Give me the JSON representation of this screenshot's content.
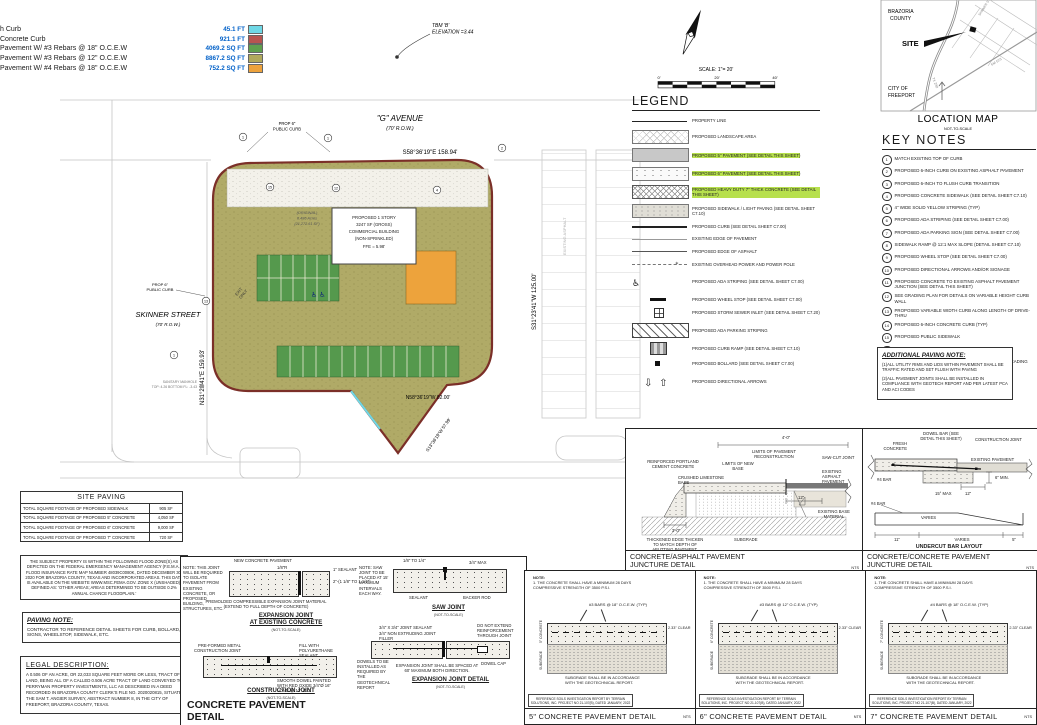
{
  "quantities": {
    "rows": [
      {
        "label": "h Curb",
        "value": "45.1 FT",
        "color": "#6fd8e6"
      },
      {
        "label": "Concrete Curb",
        "value": "921.1 FT",
        "color": "#b85450"
      },
      {
        "label": "Pavement W/ #3 Rebars @ 18\" O.C.E.W",
        "value": "4069.2 SQ FT",
        "color": "#5fa04e"
      },
      {
        "label": "Pavement W/ #3 Rebars @ 12\" O.C.E.W",
        "value": "8867.2 SQ FT",
        "color": "#b0a95c"
      },
      {
        "label": "Pavement W/ #4 Rebars @ 18\" O.C.E.W",
        "value": "752.2 SQ FT",
        "color": "#eda23c"
      }
    ]
  },
  "north_scale": {
    "label": "SCALE: 1\"= 20'",
    "t0": "0'",
    "t1": "20'",
    "t2": "40'"
  },
  "plan": {
    "tbm_1": "TBM 'B'",
    "tbm_2": "ELEVATION =3.44",
    "g_avenue": "\"G\" AVENUE",
    "g_avenue_row": "(70' R.O.W.)",
    "skinner": "SKINNER STREET",
    "skinner_row": "(70' R.O.W.)",
    "prop_curb_1": "PROP 6\"",
    "prop_curb_2": "PUBLIC CURB",
    "bearing_top": "S58°36'19\"E   158.94'",
    "bearing_left": "N31°23'41\"E   159.93'",
    "bearing_right": "S31°23'41\"W   125.00'",
    "bearing_bottom": "N58°36'19\"W 82.00'",
    "bearing_diag": "S13°36'19\"W 57.99'",
    "building": [
      "PROPOSED 1 STORY",
      "3247 SF (GROSS)",
      "COMMERCIAL BUILDING",
      "(NON-SPRINKLED)",
      "FFE = 5.98'"
    ],
    "parcel": [
      "(ORIGINAL)",
      "0.486 Acres",
      "(21,272.61 SF)"
    ],
    "exit_1": "EXIT",
    "exit_2": "ONLY",
    "ada_symbols": "♿ ♿",
    "sanitary_1": "SANITARY MANHOLE",
    "sanitary_2": "TOP: 4.26  BOTTOM FL: -3.43",
    "existing_asphalt": "EXISTING ASPHALT",
    "callouts": [
      "1",
      "1",
      "15",
      "12",
      "4",
      "13",
      "1",
      "2"
    ]
  },
  "legend": {
    "title": "LEGEND",
    "items": [
      {
        "swatch": "sw-line",
        "label": "PROPERTY LINE"
      },
      {
        "swatch": "sw-landscape",
        "label": "PROPOSED LANDSCAPE AREA"
      },
      {
        "swatch": "sw-5in",
        "label": "PROPOSED 5\" PAVEMENT (SEE DETAIL THIS SHEET)",
        "hl": "hl"
      },
      {
        "swatch": "sw-6in",
        "label": "PROPOSED 6\" PAVEMENT (SEE DETAIL THIS SHEET)",
        "hl": "hl"
      },
      {
        "swatch": "sw-7in",
        "label": "PROPOSED HEAVY DUTY 7\" THICK CONCRETE (SEE DETAIL THIS SHEET)",
        "hl": "hl"
      },
      {
        "swatch": "sw-sidewalk",
        "label": "PROPOSED SIDEWALK / LIGHT PAVING (SEE DETAIL SHEET C7.10)"
      },
      {
        "swatch": "sw-curb",
        "label": "PROPOSED CURB (SEE DETAIL SHEET C7.00)"
      },
      {
        "swatch": "sw-existedge",
        "label": "EXISTING EDGE OF PAVEMENT"
      },
      {
        "swatch": "sw-asphedge",
        "label": "PROPOSED EDGE OF ASPHALT"
      },
      {
        "swatch": "sw-power",
        "label": "EXISTING OVERHEAD POWER AND POWER POLE"
      },
      {
        "swatch": "sw-ada",
        "label": "PROPOSED ADA STRIPING (SEE DETAIL SHEET C7.00)"
      },
      {
        "swatch": "sw-wheelstop",
        "label": "PROPOSED WHEEL STOP (SEE DETAIL SHEET C7.00)"
      },
      {
        "swatch": "sw-inlet",
        "label": "PROPOSED STORM SEWER INLET (SEE DETAIL SHEET C7.20)"
      },
      {
        "swatch": "sw-adastripe",
        "label": "PROPOSED ADA PARKING STRIPING"
      },
      {
        "swatch": "sw-ramp",
        "label": "PROPOSED CURB RAMP (SEE DETAIL SHEET C7.10)"
      },
      {
        "swatch": "sw-bollard",
        "label": "PROPOSED BOLLARD (SEE DETAIL SHEET C7.00)"
      },
      {
        "swatch": "sw-arrows",
        "label": "PROPOSED DIRECTIONAL ARROWS"
      }
    ]
  },
  "location_map": {
    "title": "LOCATION MAP",
    "subtitle": "NOT-TO-SCALE",
    "county_1": "BRAZORIA",
    "county_2": "COUNTY",
    "site": "SITE",
    "city_1": "CITY OF",
    "city_2": "FREEPORT",
    "roads": [
      "SKINNER ST",
      "FM 523",
      "TX 288"
    ]
  },
  "key_notes": {
    "title": "KEY NOTES",
    "items": [
      {
        "num": "1",
        "text": "MATCH EXISTING TOP OF CURB"
      },
      {
        "num": "2",
        "text": "PROPOSED 6-INCH CURB ON EXISTING ASPHALT PAVEMENT"
      },
      {
        "num": "3",
        "text": "PROPOSED 6-INCH TO FLUSH CURB TRANSITION"
      },
      {
        "num": "4",
        "text": "PROPOSED CONCRETE SIDEWALK (SEE DETAIL SHEET C7.10)"
      },
      {
        "num": "5",
        "text": "4\" WIDE SOLID YELLOW STRIPING (TYP)"
      },
      {
        "num": "6",
        "text": "PROPOSED ADA STRIPING (SEE DETAIL SHEET C7.00)"
      },
      {
        "num": "7",
        "text": "PROPOSED ADA PARKING SIGN (SEE DETAIL SHEET C7.00)"
      },
      {
        "num": "8",
        "text": "SIDEWALK RAMP @ 12:1 MAX SLOPE (DETAIL SHEET C7.10)"
      },
      {
        "num": "9",
        "text": "PROPOSED WHEEL STOP (SEE DETAIL SHEET C7.00)"
      },
      {
        "num": "10",
        "text": "PROPOSED DIRECTIONAL ARROWS AND/OR SIGNAGE"
      },
      {
        "num": "11",
        "text": "PROPOSED CONCRETE TO EXISTING ASPHALT PAVEMENT JUNCTION (SEE DETAIL THIS SHEET)"
      },
      {
        "num": "12",
        "text": "SEE GRADING PLAN FOR DETAILS ON VARIABLE HEIGHT CURB WALL"
      },
      {
        "num": "13",
        "text": "PROPOSED VARIABLE WIDTH CURB ALONG LENGTH OF DRIVE-THRU"
      },
      {
        "num": "14",
        "text": "PROPOSED 6-INCH CONCRETE CURB (TYP)"
      },
      {
        "num": "15",
        "text": "PROPOSED PUBLIC SIDEWALK"
      },
      {
        "num": "16",
        "text": "PROPOSED CURB CUT FOR SIDEWALK"
      },
      {
        "num": "17",
        "text": "PROPOSED SAW TOOTH CURB (SEE MORE INFO ON GRADING SHEET)"
      }
    ]
  },
  "additional_paving_note": {
    "title": "ADDITIONAL PAVING NOTE:",
    "body1": "(1)ALL UTILITY RIMS AND LIDS WITHIN PAVEMENT SHALL BE TRAFFIC RATED AND SET FLUSH WITH PAVING",
    "body2": "(2)ALL PAVEMENT JOINTS SHALL BE INSTALLED IN COMPLIANCE WITH GEOTECH REPORT AND PER LATEST PCA AND ACI CODES"
  },
  "site_paving": {
    "title": "SITE PAVING",
    "rows": [
      {
        "label": "TOTAL SQUARE FOOTAGE OF PROPOSED SIDEWALK",
        "value": "905 SF"
      },
      {
        "label": "TOTAL SQUARE FOOTAGE OF PROPOSED 5\" CONCRETE",
        "value": "4,050 SF"
      },
      {
        "label": "TOTAL SQUARE FOOTAGE OF PROPOSED 6\" CONCRETE",
        "value": "9,000 SF"
      },
      {
        "label": "TOTAL SQUARE FOOTAGE OF PROPOSED 7\" CONCRETE",
        "value": "720 SF"
      }
    ]
  },
  "flood_note": "THE SUBJECT PROPERTY IS WITHIN THE FOLLOWING FLOOD ZONE(S) AS DEPICTED ON THE FEDERAL EMERGENCY MANAGEMENT AGENCY (F.E.M.A.) FLOOD INSURANCE RATE MAP NUMBER 48039C0080K, DATED DECEMBER 30, 2020 FOR BRAZORIA COUNTY, TEXAS AND INCORPORATED AREAS. THIS DATA IS AVAILABLE ON THE WEBSITE WWW.MSC.FEMA.GOV. ZONE X (UNSHADED), DEFINED AS: 'OTHER AREAS; AREAS DETERMINED TO BE OUTSIDE 0.2% ANNUAL CHANCE FLOODPLAIN.'",
  "paving_note": {
    "title": "PAVING NOTE:",
    "body": "CONTRACTOR TO REFERENCE DETAIL SHEETS FOR CURB, BOLLARD, SIGNS, WHEELSTOP, SIDEWALK, ETC."
  },
  "legal_description": {
    "title": "LEGAL DESCRIPTION:",
    "body": "A 0.506 OF AN ACRE, OR 22,033 SQUARE FEET MORE OR LESS, TRACT OF LAND, BEING ALL OF A CALLED 0.506 ACRE TRACT OF LAND CONVEYED TO PERRYMAN PROPERTY INVESTMENTS, LLC AS DESCRIBED IN A DEED RECORDED IN BRAZORIA COUNTY CLERK'S FILE NO. 2020020815, SITUATED IN THE SAM T. ANGIER SURVEY, ABSTRACT NUMBER 8, IN THE CITY OF FREEPORT, BRAZORIA COUNTY, TEXAS."
  },
  "concrete_detail": {
    "big_title_1": "CONCRETE PAVEMENT",
    "big_title_2": "DETAIL",
    "nts": "(NOT-TO-SCALE)",
    "expansion_existing": {
      "title_1": "EXPANSION JOINT",
      "title_2": "AT EXISTING CONCRETE",
      "note": "NOTE: THIS JOINT WILL BE REQUIRED TO ISOLATE PAVEMENT FROM EXISTING CONCRETE, OR PROPOSED BUILDING, STRUCTURES, ETC.",
      "label_pavement": "NEW CONCRETE PAVEMENT",
      "label_radius": "1/8\"R",
      "label_sealant": "1\" SEALANT",
      "label_dim": "2\"-(1 1/8\" TO 1 1/4\")",
      "label_premolded": "PREMOLDED COMPRESSIBLE EXPANSION JOINT MATERIAL (EXTEND TO FULL DEPTH OF CONCRETE)"
    },
    "construction_joint": {
      "title": "CONSTRUCTION JOINT",
      "label_metal": "PRE-FORMED METAL CONSTRUCTION JOINT",
      "label_fill": "FILL WITH POLYURETHANE SEALANT",
      "label_dowel": "SMOOTH DOWEL PAINTED WITH RED OXIDE 3/4\"Ø 16\" LONG @ 12\" O.C."
    },
    "saw_joint": {
      "title": "SAW JOINT",
      "note": "NOTE: SAW JOINT TO BE PLACED AT 15' MAXIMUM INTERVALS EACH WAY.",
      "dim1": "1/8\" TO 1/4\"",
      "dim2": "3/4\" MAX",
      "label_sealant": "SEALANT",
      "label_backer": "BACKER ROD"
    },
    "expansion_detail": {
      "title": "EXPANSION JOINT DETAIL",
      "label_sealant": "3/4\" X 3/4\" JOINT SEALANT",
      "label_filler": "3/4\" NON EXTRUDING JOINT FILLER",
      "label_reinf": "DO NOT EXTEND REINFORCEMENT THROUGH JOINT",
      "label_cap": "DOWEL CAP",
      "label_dowels": "DOWELS TO BE INSTALLED AS REQUIRED BY THE GEOTECHNICAL REPORT",
      "label_spacing": "EXPANSION JOINT SHALL BE SPACED AT 60' MAXIMUM BOTH DIRECTION."
    }
  },
  "juncture_asphalt": {
    "title_1": "CONCRETE/ASPHALT PAVEMENT",
    "title_2": "JUNCTURE DETAIL",
    "nts": "NTS",
    "labels": {
      "dim4": "4'-0\"",
      "limits": "LIMITS OF PAVEMENT RECONSTRUCTION",
      "reinforced": "REINFORCED PORTLAND CEMENT CONCRETE",
      "limits_base": "LIMITS OF NEW BASE",
      "sawcut": "SAW-CUT JOINT",
      "crushed": "CRUSHED LIMESTONE BASE",
      "exist_asphalt": "EXISTING ASPHALT PAVEMENT",
      "dim12": "12\"",
      "exist_base": "EXISTING BASE MATERIAL",
      "subgrade": "SUBGRADE",
      "dim3": "3'-0\"",
      "thickened": "THICKENED EDGE THICKEN TO MATCH DEPTH OF ABUTTING PAVEMENT."
    }
  },
  "juncture_concrete": {
    "title_1": "CONCRETE/CONCRETE PAVEMENT",
    "title_2": "JUNCTURE DETAIL",
    "nts": "NTS",
    "labels": {
      "dowel": "DOWEL BAR (SEE DETAIL THIS SHEET)",
      "construction": "CONSTRUCTION JOINT",
      "fresh": "FRESH CONCRETE",
      "existing": "EXISTING PAVEMENT",
      "bar4": "#4 BAR",
      "min6": "6\" MIN.",
      "max15": "15° MAX",
      "dim12": "12\""
    },
    "undercut": {
      "title": "UNDERCUT BAR LAYOUT",
      "subtitle": "SEE ROADWAY SECTION FOR REBAR",
      "bar4": "#4 BAR",
      "varies": "VARIES",
      "dim11": "11\"",
      "varies2": "VARIES",
      "dim5": "5\""
    }
  },
  "pavement_details": [
    {
      "title": "5\" CONCRETE PAVEMENT DETAIL",
      "nts": "NTS",
      "note_head": "NOTE:",
      "note_body": "1. THE CONCRETE SHALL HAVE A MINIMUM 28 DAYS COMPRESSIVE STRENGTH OF 3500 P.S.I.",
      "bars": "#3 BARS @ 18\" O.C.E.W. (TYP)",
      "clear": "2.33\" CLEAR",
      "depth_label": "5\" CONCRETE",
      "sub_label": "SUBGRADE",
      "subgrade_note": "SUBGRADE SHALL BE IN ACCORDANCE WITH THE GEOTECHNICAL REPORT.",
      "ref": "REFERENCE SOILS INVESTIGATION REPORT BY TERRAIN SOLUTIONS, INC. PROJECT NO 21-107(B), DATED JANUARY, 2022"
    },
    {
      "title": "6\" CONCRETE PAVEMENT DETAIL",
      "nts": "NTS",
      "note_head": "NOTE:",
      "note_body": "1. THE CONCRETE SHALL HAVE A MINIMUM 28 DAYS COMPRESSIVE STRENGTH OF 3500 P.S.I.",
      "bars": "#3 BARS @ 12\" O.C.E.W. (TYP)",
      "clear": "2.33\" CLEAR",
      "depth_label": "6\" CONCRETE",
      "sub_label": "SUBGRADE",
      "subgrade_note": "SUBGRADE SHALL BE IN ACCORDANCE WITH THE GEOTECHNICAL REPORT.",
      "ref": "REFERENCE SOILS INVESTIGATION REPORT BY TERRAIN SOLUTIONS, INC. PROJECT NO 21-107(B), DATED JANUARY, 2022"
    },
    {
      "title": "7\" CONCRETE PAVEMENT DETAIL",
      "nts": "NTS",
      "note_head": "NOTE:",
      "note_body": "1. THE CONCRETE SHALL HAVE A MINIMUM 28 DAYS COMPRESSIVE STRENGTH OF 3500 P.S.I.",
      "bars": "#4 BARS @ 18\" O.C.E.W. (TYP)",
      "clear": "2.33\" CLEAR",
      "depth_label": "7\" CONCRETE",
      "sub_label": "SUBGRADE",
      "subgrade_note": "SUBGRADE SHALL BE IN ACCORDANCE WITH THE GEOTECHNICAL REPORT.",
      "ref": "REFERENCE SOILS INVESTIGATION REPORT BY TERRAIN SOLUTIONS, INC. PROJECT NO 21-107(B), DATED JANUARY, 2022"
    }
  ]
}
